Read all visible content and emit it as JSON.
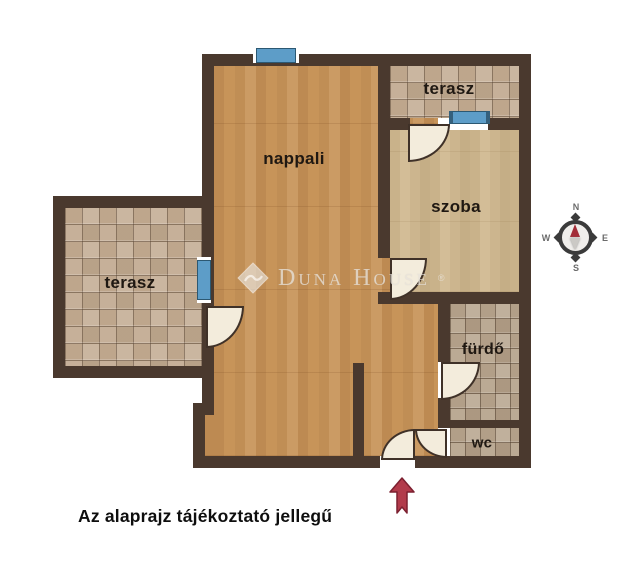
{
  "floorplan": {
    "rooms": {
      "nappali": {
        "label": "nappali"
      },
      "terasz_left": {
        "label": "terasz"
      },
      "terasz_top": {
        "label": "terasz"
      },
      "szoba": {
        "label": "szoba"
      },
      "furdo": {
        "label": "fürdő"
      },
      "wc": {
        "label": "wc"
      }
    },
    "compass": {
      "north": "N",
      "east": "E",
      "south": "S",
      "west": "W"
    },
    "watermark": {
      "brand": "Duna House",
      "registered": "®"
    },
    "disclaimer": "Az alaprajz tájékoztató jellegű"
  },
  "colors": {
    "wall": "#4a392e",
    "wood-nappali": "#c3915a",
    "wood-szoba": "#cdb791",
    "tile-terrace": "#c3ac93",
    "tile-bath": "#b7a58e",
    "window-blue": "#5d9dc8",
    "door-fill": "#f3ecdc",
    "arrow-red": "#b23b4b",
    "label": "#1f1812"
  }
}
